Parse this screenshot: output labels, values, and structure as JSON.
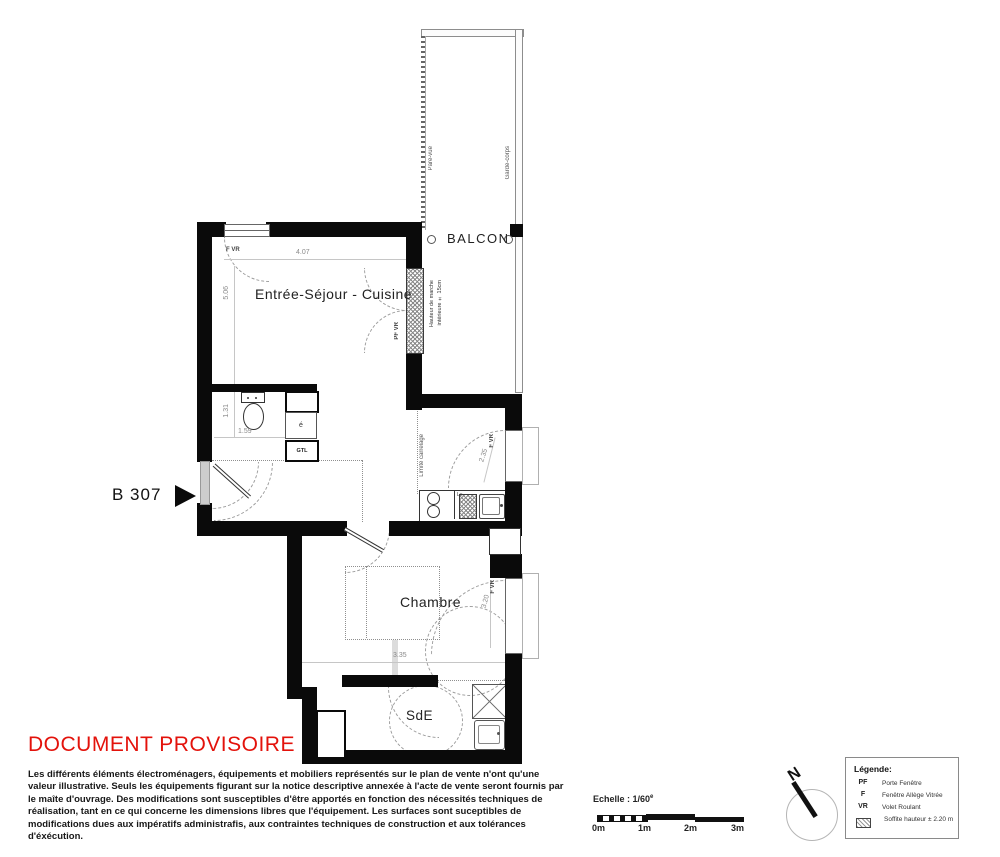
{
  "plan": {
    "unit_label": "B 307",
    "rooms": {
      "living": "Entrée-Séjour - Cuisine",
      "bedroom": "Chambre",
      "shower_room": "SdE",
      "balcony": "BALCON"
    },
    "labels": {
      "window_top": "F VR",
      "balcony_door": "PF VR",
      "window_kitchen": "F VR",
      "window_bedroom": "F VR",
      "pare_vue": "Pare-vue",
      "garde_corps": "Garde-corps",
      "step_height_line1": "Hauteur de marche",
      "step_height_line2": "intérieure ± 15cm",
      "limite_carrelage": "Limite carrelage",
      "dishwasher": "Lv",
      "elec": "é",
      "gtl": "GTL"
    },
    "dims": {
      "living_w": "4.07",
      "living_h": "5.06",
      "wc_h": "1.31",
      "wc_w": "1.59",
      "kitchen_win": "2.35",
      "bedroom_win": "3.20",
      "bedroom_w": "3.35"
    }
  },
  "status": {
    "text": "DOCUMENT PROVISOIRE",
    "color": "#e3120b"
  },
  "disclaimer": {
    "text": "Les différents éléments électroménagers, équipements et mobiliers représentés sur le plan de vente n'ont qu'une valeur illustrative. Seuls les équipements figurant sur la notice descriptive annexée à l'acte de vente seront fournis par le maîte d'ouvrage. Des modifications sont susceptibles d'être apportés en fonction des nécessités techniques de réalisation, tant en ce qui concerne les dimensions libres que l'équipement. Les surfaces sont suceptibles de modifications dues aux impératifs administrafis, aux contraintes techniques de construction et aux tolérances d'éxécution."
  },
  "scalebar": {
    "label": "Echelle : 1/60",
    "sup": "e",
    "ticks": [
      "0m",
      "1m",
      "2m",
      "3m"
    ]
  },
  "compass": {
    "north": "N"
  },
  "legend": {
    "title": "Légende:",
    "items": [
      {
        "abbr": "PF",
        "label": "Porte Fenêtre"
      },
      {
        "abbr": "F",
        "label": "Fenêtre Allège Vitrée"
      },
      {
        "abbr": "VR",
        "label": "Volet Roulant"
      },
      {
        "abbr": "",
        "label": "Soffite hauteur ± 2.20 m"
      }
    ]
  },
  "colors": {
    "wall": "#0a0a0a",
    "accent_red": "#e3120b"
  }
}
